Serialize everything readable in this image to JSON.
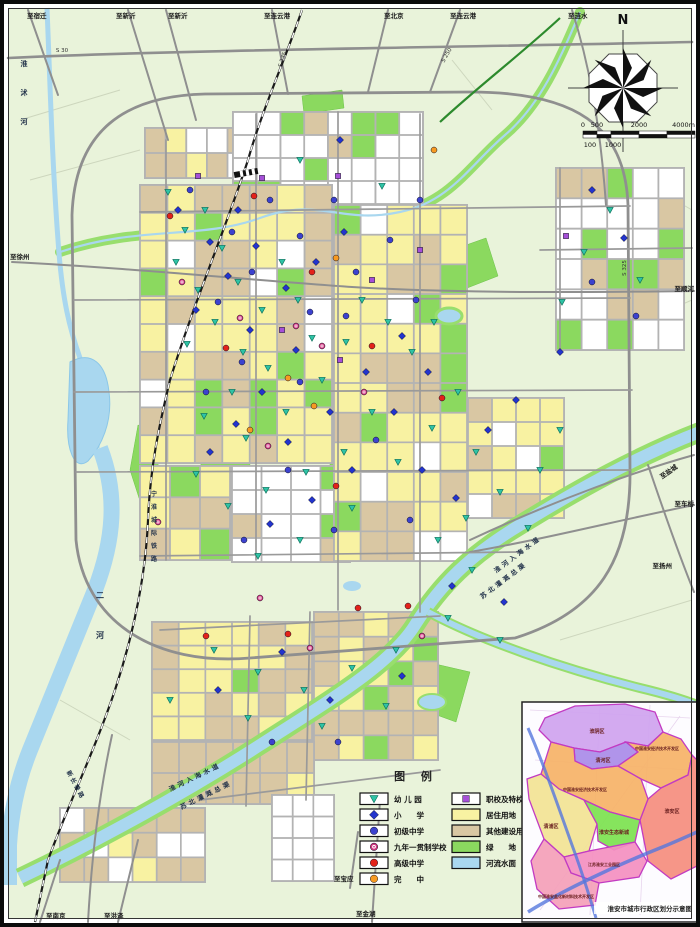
{
  "colors": {
    "land": "#e9f3da",
    "residential": "#f8f2a2",
    "other_construction": "#d9c7a3",
    "green_space": "#8bd95f",
    "water": "#a9d7ef",
    "water_edge": "#98de6d",
    "road": "#8f8f8f",
    "street": "#b3b3b3",
    "railway": "#1a1a1a",
    "kindergarten": "#2fc3a6",
    "primary": "#2334cd",
    "junior": "#3c42cf",
    "nine_year": "#d23380",
    "senior": "#e3221a",
    "wanzhong": "#f79a22",
    "vocational": "#a64fd8"
  },
  "legend": {
    "title": "图 例",
    "left_items": [
      {
        "kind": "point",
        "type": "kindergarten",
        "label": "幼 儿 园"
      },
      {
        "kind": "point",
        "type": "primary",
        "label": "小　　学"
      },
      {
        "kind": "point",
        "type": "junior",
        "label": "初级中学"
      },
      {
        "kind": "point",
        "type": "nine_year",
        "label": "九年一贯制学校"
      },
      {
        "kind": "point",
        "type": "senior",
        "label": "高级中学"
      },
      {
        "kind": "point",
        "type": "wanzhong",
        "label": "完　　中"
      }
    ],
    "right_items": [
      {
        "kind": "point",
        "type": "vocational",
        "label": "职校及特校"
      },
      {
        "kind": "area",
        "color": "residential",
        "label": "居住用地"
      },
      {
        "kind": "area",
        "color": "other_construction",
        "label": "其他建设用地"
      },
      {
        "kind": "area",
        "color": "green_space",
        "label": "绿　　地"
      },
      {
        "kind": "area",
        "color": "water",
        "label": "河流水面"
      }
    ]
  },
  "compass": {
    "north_label": "N"
  },
  "scale_bar": {
    "top": [
      "0",
      "500",
      "2000",
      "4000m"
    ],
    "bottom": [
      "100",
      "1000"
    ]
  },
  "edge_labels": [
    {
      "text": "至宿迁",
      "x": 27,
      "y": 18
    },
    {
      "text": "至新沂",
      "x": 116,
      "y": 18
    },
    {
      "text": "至新沂",
      "x": 168,
      "y": 18
    },
    {
      "text": "至连云港",
      "x": 264,
      "y": 18
    },
    {
      "text": "至北京",
      "x": 384,
      "y": 18
    },
    {
      "text": "至连云港",
      "x": 450,
      "y": 18
    },
    {
      "text": "至涟水",
      "x": 568,
      "y": 18
    },
    {
      "text": "至徐州",
      "x": 10,
      "y": 259
    },
    {
      "text": "至顺河",
      "x": 694,
      "y": 291,
      "anchor": "end"
    },
    {
      "text": "至盐城",
      "x": 678,
      "y": 468,
      "rotate": -35,
      "anchor": "end"
    },
    {
      "text": "至车桥",
      "x": 694,
      "y": 506,
      "anchor": "end"
    },
    {
      "text": "至扬州",
      "x": 672,
      "y": 568,
      "anchor": "end"
    },
    {
      "text": "至南京",
      "x": 46,
      "y": 918
    },
    {
      "text": "至洪泽",
      "x": 104,
      "y": 918
    },
    {
      "text": "至宝应",
      "x": 334,
      "y": 881
    },
    {
      "text": "至金湖",
      "x": 356,
      "y": 916
    }
  ],
  "map_labels": [
    {
      "text": "淮沭河",
      "x": 24,
      "y": 66,
      "vertical": true,
      "spacing": 29,
      "size": 7
    },
    {
      "text": "二河",
      "x": 100,
      "y": 598,
      "vertical": true,
      "spacing": 40,
      "size": 8
    },
    {
      "text": "淮河入海水道",
      "x": 519,
      "y": 556,
      "rotate": -37,
      "size": 6.5,
      "ls": 3
    },
    {
      "text": "苏北灌溉总渠",
      "x": 505,
      "y": 582,
      "rotate": -37,
      "size": 6.5,
      "ls": 3
    },
    {
      "text": "淮河入海水道",
      "x": 196,
      "y": 779,
      "rotate": -26,
      "size": 6.5,
      "ls": 3
    },
    {
      "text": "苏北灌溉总渠",
      "x": 207,
      "y": 797,
      "rotate": -26,
      "size": 6.5,
      "ls": 3
    },
    {
      "text": "宁淮城际铁路",
      "x": 154,
      "y": 496,
      "vertical": true,
      "spacing": 13,
      "size": 6
    },
    {
      "text": "新长铁路",
      "x": 74,
      "y": 786,
      "rotate": 62,
      "size": 6,
      "ls": 2
    }
  ],
  "road_numbers": [
    {
      "text": "S 235",
      "x": 284,
      "y": 60,
      "rotate": -72
    },
    {
      "text": "S 250",
      "x": 448,
      "y": 56,
      "rotate": -60
    },
    {
      "text": "S 325",
      "x": 626,
      "y": 268,
      "rotate": -90
    },
    {
      "text": "S 30",
      "x": 62,
      "y": 52,
      "rotate": 0
    }
  ],
  "inset": {
    "caption": "淮安市城市行政区划分示意图",
    "districts": [
      {
        "name": "淮阴区",
        "color": "#cfa3ef",
        "points": "545,718 575,706 625,704 655,712 663,732 648,746 626,742 600,752 574,748 551,742 539,730",
        "lx": 597,
        "ly": 733
      },
      {
        "name": "清河区",
        "color": "#a98be8",
        "points": "574,748 600,752 626,742 638,752 618,766 592,769 575,761",
        "lx": 603,
        "ly": 762
      },
      {
        "name": "中国淮安经济技术开发区",
        "color": "#f6b267",
        "points": "626,742 648,746 663,732 681,739 692,755 688,775 661,788 641,779 618,766 638,752",
        "lx": 657,
        "ly": 750
      },
      {
        "name": "淮安区",
        "color": "#f58d7e",
        "points": "661,788 688,775 692,755 697,760 697,866 671,879 648,861 640,820 648,799",
        "lx": 672,
        "ly": 813
      },
      {
        "name": "中国淮安经济技术开发区",
        "color": "#f6b267",
        "points": "551,742 574,748 575,761 592,769 618,766 641,779 648,799 640,820 610,812 584,800 559,789 541,774",
        "lx": 585,
        "ly": 791
      },
      {
        "name": "清浦区",
        "color": "#f2e394",
        "points": "541,774 559,789 584,800 597,824 589,851 564,857 544,839 529,799 527,779",
        "lx": 551,
        "ly": 828
      },
      {
        "name": "淮安生态新城",
        "color": "#7ce24f",
        "points": "597,824 584,800 610,812 640,820 635,842 614,850 598,841",
        "lx": 614,
        "ly": 834
      },
      {
        "name": "江苏淮安工业园区",
        "color": "#f48fc0",
        "points": "564,857 589,851 635,842 647,861 639,877 599,883 571,873",
        "lx": 604,
        "ly": 866
      },
      {
        "name": "中国淮安盐化新材料技术开发区",
        "color": "#f4a0b8",
        "points": "544,839 564,857 571,873 599,883 595,905 559,909 537,889 531,861",
        "lx": 566,
        "ly": 898
      }
    ]
  },
  "block_districts": [
    {
      "x": 145,
      "y": 128,
      "w": 165,
      "h": 50,
      "cols": 8,
      "rows": 2,
      "weights": {
        "tan": 0.5,
        "yellow": 0.3,
        "green": 0.1,
        "white": 0.1
      }
    },
    {
      "x": 233,
      "y": 112,
      "w": 190,
      "h": 92,
      "cols": 8,
      "rows": 4,
      "weights": {
        "white": 0.8,
        "tan": 0.1,
        "green": 0.1
      }
    },
    {
      "x": 140,
      "y": 185,
      "w": 192,
      "h": 278,
      "cols": 7,
      "rows": 10,
      "weights": {
        "yellow": 0.5,
        "tan": 0.3,
        "green": 0.12,
        "white": 0.08
      }
    },
    {
      "x": 140,
      "y": 466,
      "w": 90,
      "h": 94,
      "cols": 3,
      "rows": 3,
      "weights": {
        "yellow": 0.5,
        "tan": 0.3,
        "green": 0.2
      }
    },
    {
      "x": 232,
      "y": 466,
      "w": 118,
      "h": 96,
      "cols": 4,
      "rows": 4,
      "weights": {
        "white": 0.7,
        "tan": 0.15,
        "green": 0.15
      }
    },
    {
      "x": 334,
      "y": 205,
      "w": 133,
      "h": 356,
      "cols": 5,
      "rows": 12,
      "weights": {
        "yellow": 0.55,
        "tan": 0.2,
        "green": 0.15,
        "white": 0.1
      }
    },
    {
      "x": 468,
      "y": 398,
      "w": 96,
      "h": 120,
      "cols": 4,
      "rows": 5,
      "weights": {
        "yellow": 0.45,
        "tan": 0.3,
        "white": 0.15,
        "green": 0.1
      }
    },
    {
      "x": 556,
      "y": 168,
      "w": 128,
      "h": 182,
      "cols": 5,
      "rows": 6,
      "weights": {
        "white": 0.6,
        "tan": 0.25,
        "green": 0.15
      }
    },
    {
      "x": 152,
      "y": 622,
      "w": 160,
      "h": 118,
      "cols": 6,
      "rows": 5,
      "weights": {
        "yellow": 0.6,
        "tan": 0.3,
        "green": 0.1
      }
    },
    {
      "x": 314,
      "y": 612,
      "w": 124,
      "h": 148,
      "cols": 5,
      "rows": 6,
      "weights": {
        "tan": 0.55,
        "yellow": 0.3,
        "green": 0.15
      }
    },
    {
      "x": 152,
      "y": 742,
      "w": 162,
      "h": 62,
      "cols": 6,
      "rows": 2,
      "weights": {
        "tan": 0.8,
        "yellow": 0.2
      }
    },
    {
      "x": 60,
      "y": 808,
      "w": 145,
      "h": 74,
      "cols": 6,
      "rows": 3,
      "weights": {
        "tan": 0.7,
        "yellow": 0.15,
        "white": 0.15
      }
    },
    {
      "x": 272,
      "y": 795,
      "w": 62,
      "h": 86,
      "cols": 3,
      "rows": 4,
      "weights": {
        "white": 1
      }
    }
  ],
  "symbols": {
    "kindergarten": [
      [
        168,
        192
      ],
      [
        185,
        230
      ],
      [
        205,
        210
      ],
      [
        176,
        262
      ],
      [
        198,
        290
      ],
      [
        222,
        248
      ],
      [
        238,
        282
      ],
      [
        215,
        322
      ],
      [
        187,
        344
      ],
      [
        243,
        352
      ],
      [
        262,
        310
      ],
      [
        282,
        262
      ],
      [
        298,
        300
      ],
      [
        312,
        338
      ],
      [
        268,
        368
      ],
      [
        232,
        392
      ],
      [
        204,
        416
      ],
      [
        246,
        438
      ],
      [
        286,
        412
      ],
      [
        322,
        380
      ],
      [
        346,
        342
      ],
      [
        362,
        300
      ],
      [
        388,
        322
      ],
      [
        412,
        352
      ],
      [
        434,
        322
      ],
      [
        372,
        412
      ],
      [
        344,
        452
      ],
      [
        306,
        472
      ],
      [
        266,
        490
      ],
      [
        228,
        506
      ],
      [
        196,
        474
      ],
      [
        352,
        508
      ],
      [
        398,
        462
      ],
      [
        432,
        428
      ],
      [
        458,
        392
      ],
      [
        476,
        452
      ],
      [
        500,
        492
      ],
      [
        466,
        518
      ],
      [
        438,
        540
      ],
      [
        300,
        540
      ],
      [
        258,
        556
      ],
      [
        472,
        570
      ],
      [
        540,
        470
      ],
      [
        560,
        430
      ],
      [
        610,
        210
      ],
      [
        584,
        252
      ],
      [
        640,
        280
      ],
      [
        214,
        650
      ],
      [
        258,
        672
      ],
      [
        304,
        690
      ],
      [
        352,
        668
      ],
      [
        396,
        650
      ],
      [
        248,
        718
      ],
      [
        322,
        726
      ],
      [
        386,
        706
      ],
      [
        448,
        618
      ],
      [
        500,
        640
      ],
      [
        170,
        700
      ],
      [
        562,
        302
      ],
      [
        528,
        528
      ],
      [
        300,
        160
      ],
      [
        382,
        186
      ]
    ],
    "primary": [
      [
        178,
        210
      ],
      [
        210,
        242
      ],
      [
        238,
        210
      ],
      [
        256,
        246
      ],
      [
        228,
        276
      ],
      [
        196,
        310
      ],
      [
        250,
        330
      ],
      [
        286,
        288
      ],
      [
        316,
        262
      ],
      [
        344,
        232
      ],
      [
        296,
        350
      ],
      [
        262,
        392
      ],
      [
        236,
        424
      ],
      [
        210,
        452
      ],
      [
        288,
        442
      ],
      [
        330,
        412
      ],
      [
        366,
        372
      ],
      [
        402,
        336
      ],
      [
        428,
        372
      ],
      [
        394,
        412
      ],
      [
        352,
        470
      ],
      [
        312,
        500
      ],
      [
        270,
        524
      ],
      [
        422,
        470
      ],
      [
        456,
        498
      ],
      [
        488,
        430
      ],
      [
        516,
        400
      ],
      [
        592,
        190
      ],
      [
        624,
        238
      ],
      [
        560,
        352
      ],
      [
        282,
        652
      ],
      [
        330,
        700
      ],
      [
        402,
        676
      ],
      [
        218,
        690
      ],
      [
        452,
        586
      ],
      [
        504,
        602
      ],
      [
        340,
        140
      ]
    ],
    "junior": [
      [
        190,
        190
      ],
      [
        232,
        232
      ],
      [
        270,
        200
      ],
      [
        300,
        236
      ],
      [
        334,
        200
      ],
      [
        218,
        302
      ],
      [
        252,
        272
      ],
      [
        310,
        312
      ],
      [
        356,
        272
      ],
      [
        390,
        240
      ],
      [
        242,
        362
      ],
      [
        206,
        392
      ],
      [
        300,
        382
      ],
      [
        346,
        316
      ],
      [
        416,
        300
      ],
      [
        376,
        440
      ],
      [
        334,
        530
      ],
      [
        288,
        470
      ],
      [
        244,
        540
      ],
      [
        410,
        520
      ],
      [
        592,
        282
      ],
      [
        636,
        316
      ],
      [
        338,
        742
      ],
      [
        272,
        742
      ],
      [
        420,
        200
      ]
    ],
    "senior": [
      [
        170,
        216
      ],
      [
        254,
        196
      ],
      [
        226,
        348
      ],
      [
        312,
        272
      ],
      [
        372,
        346
      ],
      [
        442,
        398
      ],
      [
        336,
        486
      ],
      [
        358,
        608
      ],
      [
        408,
        606
      ],
      [
        206,
        636
      ],
      [
        288,
        634
      ]
    ],
    "nine_year": [
      [
        182,
        282
      ],
      [
        240,
        318
      ],
      [
        296,
        326
      ],
      [
        268,
        446
      ],
      [
        322,
        346
      ],
      [
        364,
        392
      ],
      [
        158,
        522
      ],
      [
        260,
        598
      ],
      [
        310,
        648
      ],
      [
        422,
        636
      ]
    ],
    "wanzhong": [
      [
        250,
        430
      ],
      [
        336,
        258
      ],
      [
        288,
        378
      ],
      [
        434,
        150
      ],
      [
        314,
        406
      ]
    ],
    "vocational": [
      [
        198,
        176
      ],
      [
        262,
        178
      ],
      [
        338,
        176
      ],
      [
        282,
        330
      ],
      [
        372,
        280
      ],
      [
        340,
        360
      ],
      [
        420,
        250
      ],
      [
        566,
        236
      ]
    ]
  }
}
